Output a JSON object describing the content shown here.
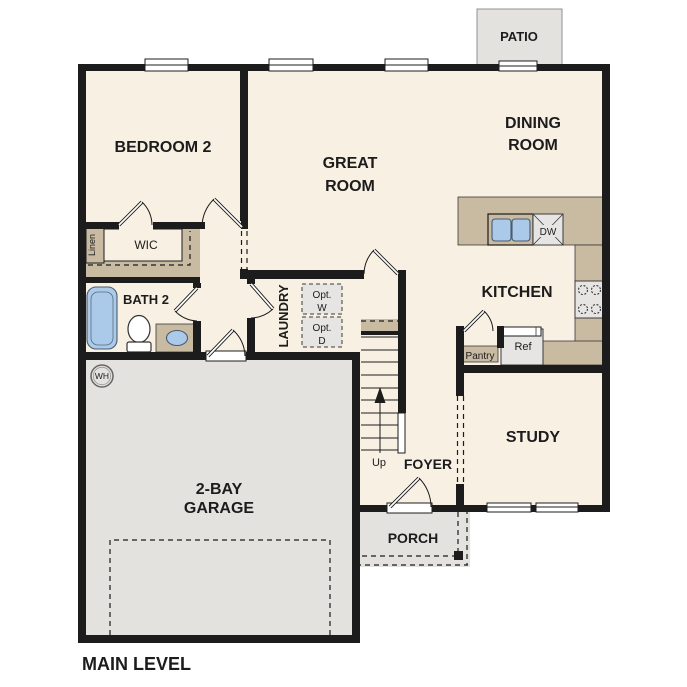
{
  "title": "MAIN LEVEL",
  "colors": {
    "wall": "#1c1c1c",
    "floor": "#f8f0e3",
    "hard": "#e3e2df",
    "counter": "#c9baa2",
    "appl": "#e6e5e3",
    "fixture": "#abc9e9",
    "ink": "#1c1c1c"
  },
  "rooms": {
    "bedroom2": {
      "label": "BEDROOM 2"
    },
    "great_room": {
      "line1": "GREAT",
      "line2": "ROOM"
    },
    "dining_room": {
      "line1": "DINING",
      "line2": "ROOM"
    },
    "kitchen": {
      "label": "KITCHEN"
    },
    "study": {
      "label": "STUDY"
    },
    "foyer": {
      "label": "FOYER"
    },
    "laundry": {
      "label": "LAUNDRY"
    },
    "bath2": {
      "label": "BATH 2"
    },
    "wic": {
      "label": "WIC"
    },
    "linen": {
      "label": "Linen"
    },
    "pantry": {
      "label": "Pantry"
    },
    "garage": {
      "line1": "2-BAY",
      "line2": "GARAGE"
    },
    "porch": {
      "label": "PORCH"
    },
    "patio": {
      "label": "PATIO"
    }
  },
  "fixtures": {
    "dishwasher": "DW",
    "refrigerator": "Ref",
    "water_heater": "WH",
    "stairs_direction": "Up",
    "opt_washer": {
      "line1": "Opt.",
      "line2": "W"
    },
    "opt_dryer": {
      "line1": "Opt.",
      "line2": "D"
    }
  }
}
